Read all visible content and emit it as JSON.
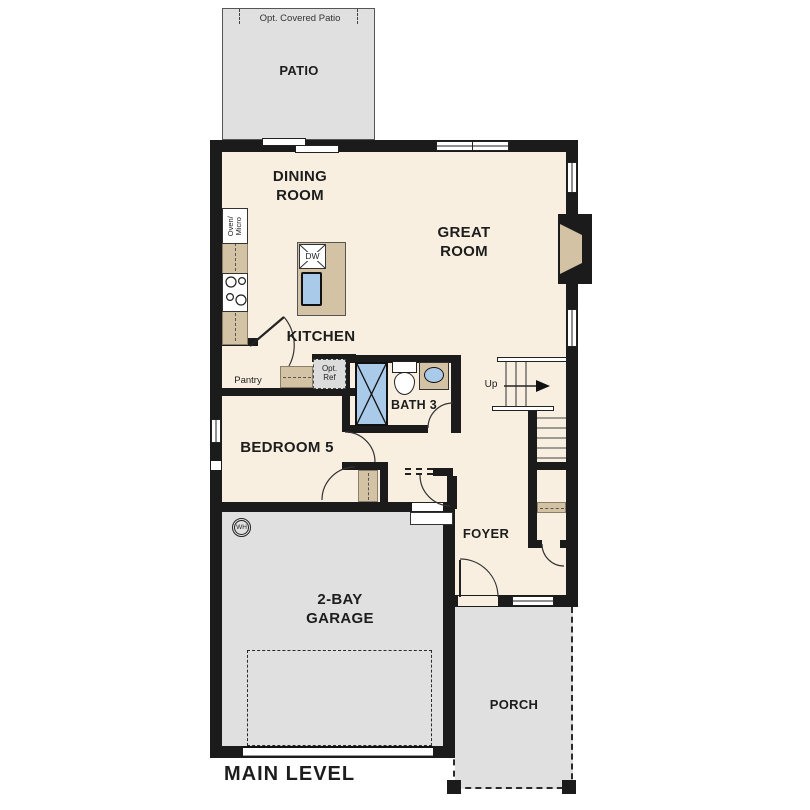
{
  "meta": {
    "title_label": "MAIN LEVEL"
  },
  "rooms": {
    "patio": {
      "name": "PATIO",
      "option_note": "Opt. Covered Patio"
    },
    "dining_room": {
      "name": "DINING\nROOM"
    },
    "great_room": {
      "name": "GREAT\nROOM"
    },
    "kitchen": {
      "name": "KITCHEN"
    },
    "bath3": {
      "name": "BATH 3"
    },
    "bedroom5": {
      "name": "BEDROOM 5"
    },
    "foyer": {
      "name": "FOYER"
    },
    "garage": {
      "name": "2-BAY\nGARAGE"
    },
    "porch": {
      "name": "PORCH"
    }
  },
  "labels": {
    "oven_micro": "Oven/\nMicro",
    "dishwasher": "DW",
    "pantry": "Pantry",
    "opt_ref": "Opt.\nRef",
    "stairs_up": "Up",
    "water_heater": "WH"
  },
  "colors": {
    "wall": "#1b1b1b",
    "floor": "#f8efe1",
    "outdoor": "#e0e0e0",
    "counter": "#d3c2a4",
    "fixture_blue": "#a9cae8"
  }
}
